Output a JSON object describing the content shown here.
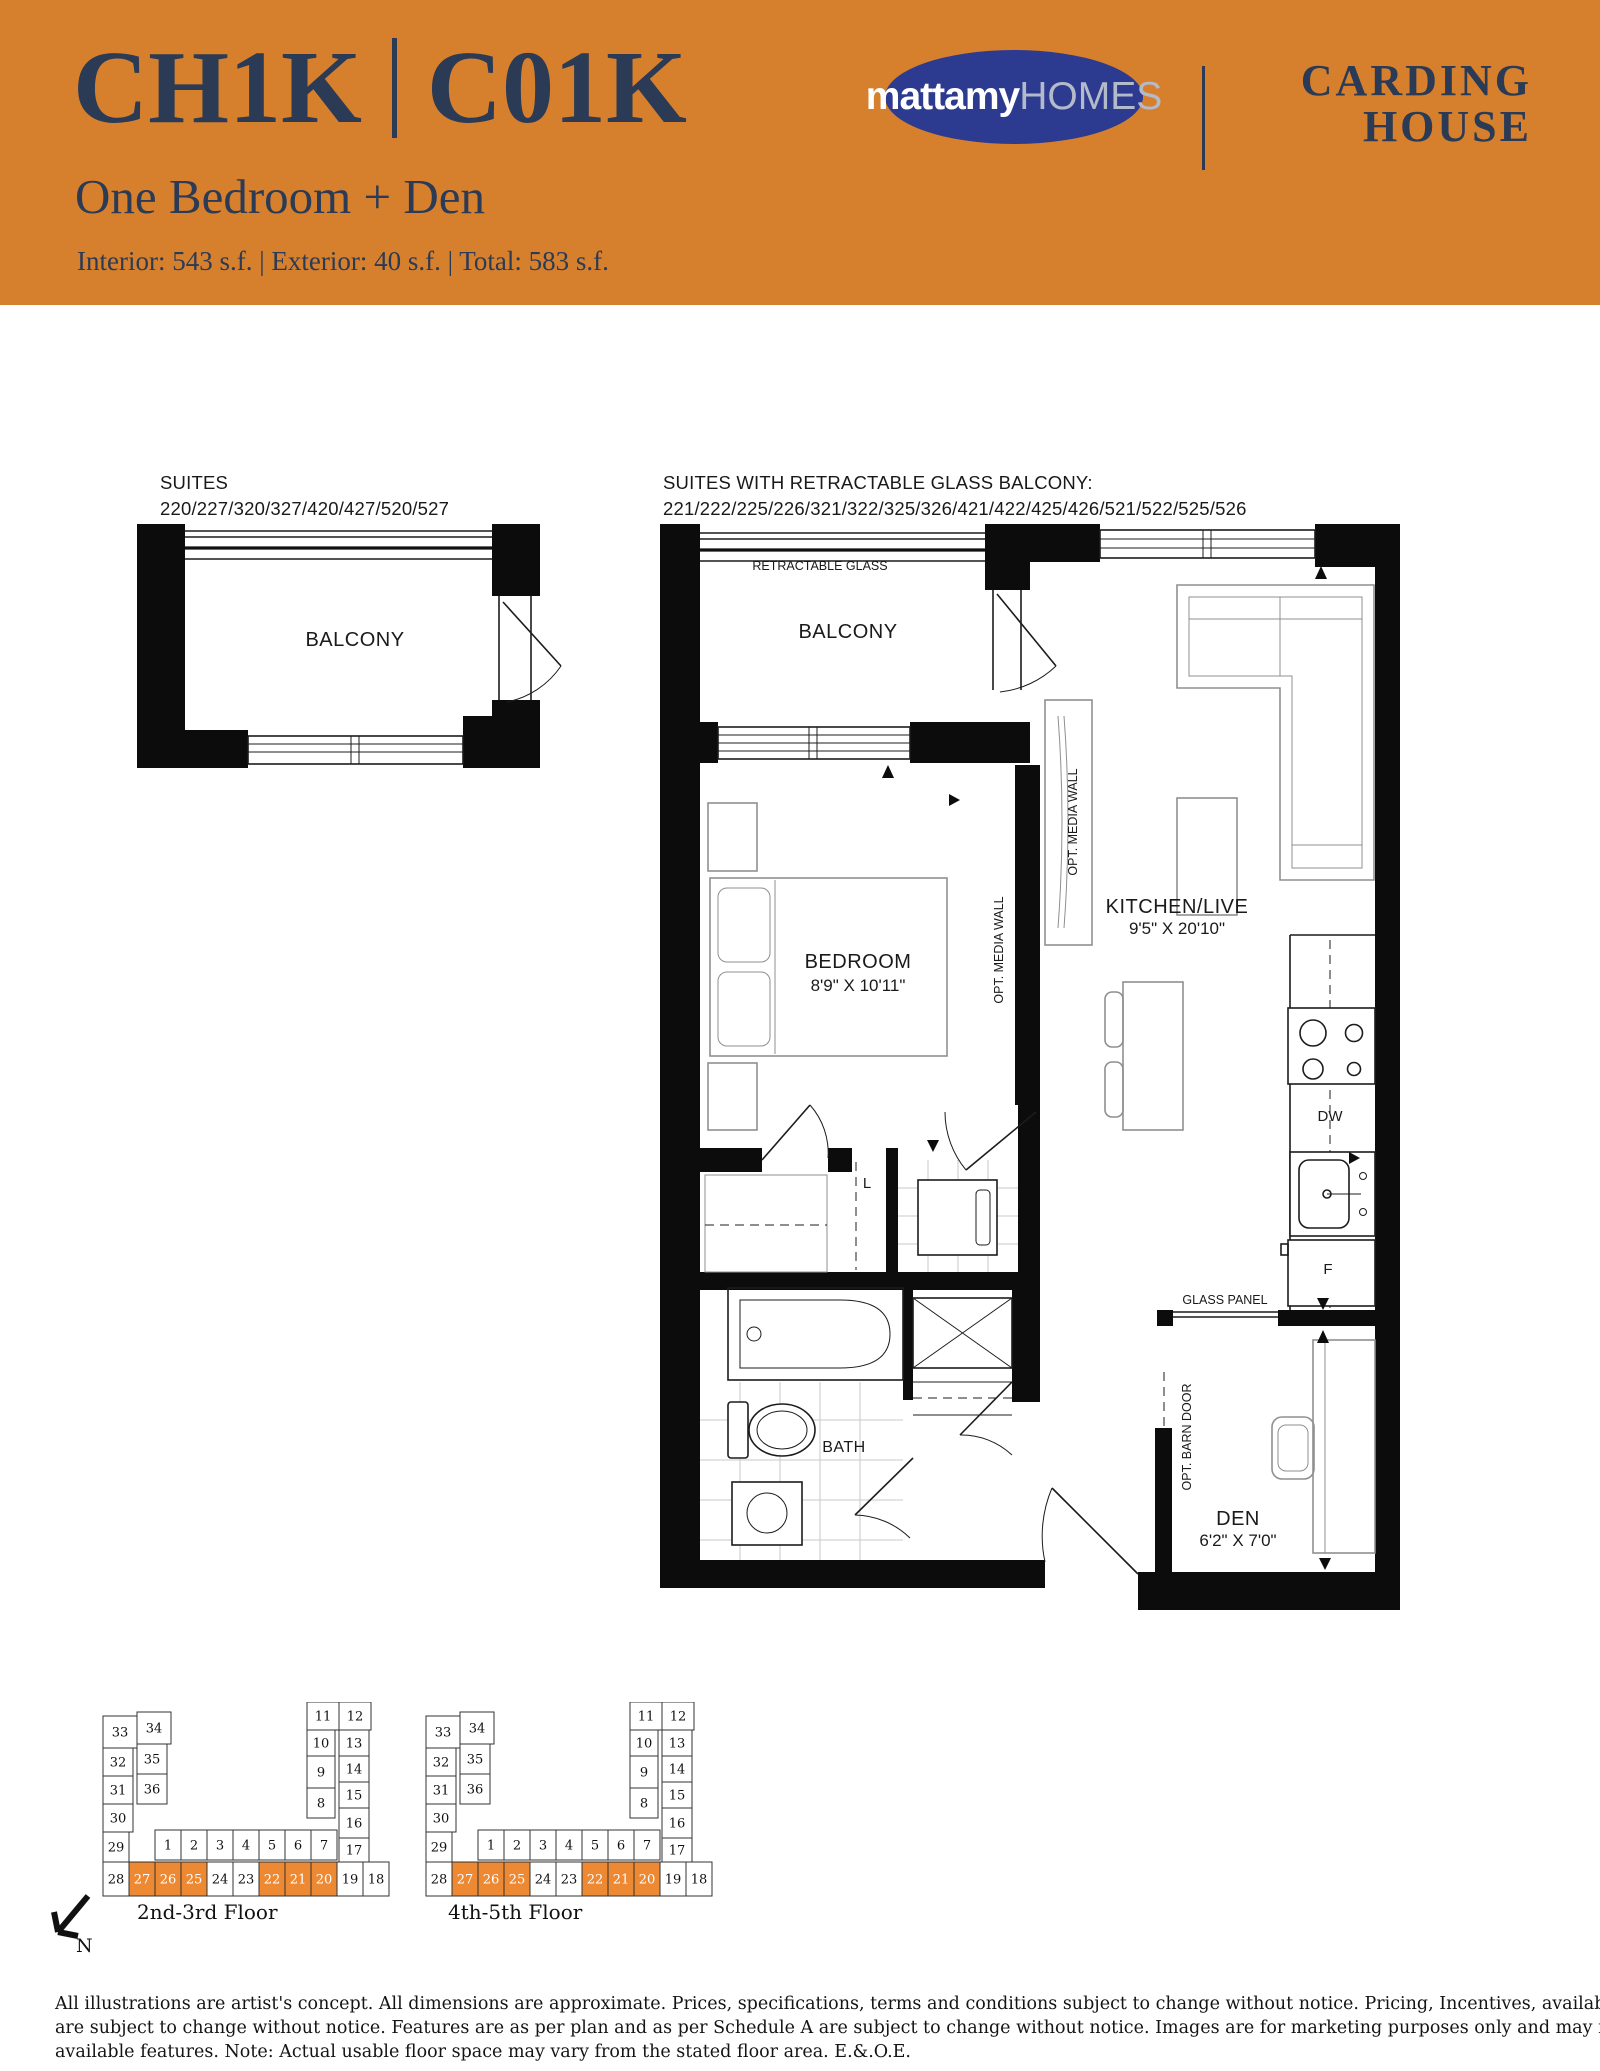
{
  "header": {
    "model_code_left": "CH1K",
    "model_code_right": "C01K",
    "unit_type": "One Bedroom + Den",
    "area_summary": "Interior: 543 s.f. | Exterior: 40 s.f. | Total: 583 s.f.",
    "logo_bold": "mattamy",
    "logo_light": "HOMES",
    "project_line1": "CARDING",
    "project_line2": "HOUSE",
    "colors": {
      "band": "#D6802E",
      "navy": "#2B3A55",
      "logo_blue": "#2C3A8F"
    }
  },
  "plans": {
    "standard": {
      "suites_title": "SUITES",
      "suites_numbers": "220/227/320/327/420/427/520/527",
      "balcony": "BALCONY"
    },
    "retractable": {
      "suites_title": "SUITES WITH RETRACTABLE GLASS BALCONY:",
      "suites_numbers": "221/222/225/226/321/322/325/326/421/422/425/426/521/522/525/526",
      "retractable_glass": "RETRACTABLE GLASS",
      "balcony": "BALCONY",
      "bedroom_name": "BEDROOM",
      "bedroom_dims": "8'9\" X 10'11\"",
      "kitchen_name": "KITCHEN/LIVE",
      "kitchen_dims": "9'5\" X 20'10\"",
      "den_name": "DEN",
      "den_dims": "6'2\" X 7'0\"",
      "bath": "BATH",
      "laundry": "L",
      "dishwasher": "DW",
      "fridge": "F",
      "glass_panel": "GLASS PANEL",
      "opt_media_wall": "OPT. MEDIA WALL",
      "opt_barn_door": "OPT. BARN DOOR"
    }
  },
  "keyplans": {
    "floors": [
      "2nd-3rd Floor",
      "4th-5th Floor"
    ],
    "north_label": "N",
    "highlight_color": "#ED8833",
    "highlighted_units": [
      "27",
      "26",
      "25",
      "22",
      "21",
      "20"
    ],
    "cells": [
      {
        "n": "33",
        "x": 8,
        "y": 14,
        "w": 34,
        "h": 32
      },
      {
        "n": "34",
        "x": 42,
        "y": 10,
        "w": 34,
        "h": 32
      },
      {
        "n": "32",
        "x": 8,
        "y": 46,
        "w": 30,
        "h": 28
      },
      {
        "n": "35",
        "x": 42,
        "y": 42,
        "w": 30,
        "h": 30
      },
      {
        "n": "31",
        "x": 8,
        "y": 74,
        "w": 30,
        "h": 28
      },
      {
        "n": "36",
        "x": 42,
        "y": 72,
        "w": 30,
        "h": 30
      },
      {
        "n": "30",
        "x": 8,
        "y": 102,
        "w": 30,
        "h": 28
      },
      {
        "n": "29",
        "x": 8,
        "y": 130,
        "w": 26,
        "h": 30
      },
      {
        "n": "1",
        "x": 60,
        "y": 128,
        "w": 26,
        "h": 30
      },
      {
        "n": "2",
        "x": 86,
        "y": 128,
        "w": 26,
        "h": 30
      },
      {
        "n": "3",
        "x": 112,
        "y": 128,
        "w": 26,
        "h": 30
      },
      {
        "n": "4",
        "x": 138,
        "y": 128,
        "w": 26,
        "h": 30
      },
      {
        "n": "5",
        "x": 164,
        "y": 128,
        "w": 26,
        "h": 30
      },
      {
        "n": "6",
        "x": 190,
        "y": 128,
        "w": 26,
        "h": 30
      },
      {
        "n": "7",
        "x": 216,
        "y": 128,
        "w": 26,
        "h": 30
      },
      {
        "n": "28",
        "x": 8,
        "y": 160,
        "w": 26,
        "h": 34
      },
      {
        "n": "27",
        "x": 34,
        "y": 160,
        "w": 26,
        "h": 34
      },
      {
        "n": "26",
        "x": 60,
        "y": 160,
        "w": 26,
        "h": 34
      },
      {
        "n": "25",
        "x": 86,
        "y": 160,
        "w": 26,
        "h": 34
      },
      {
        "n": "24",
        "x": 112,
        "y": 160,
        "w": 26,
        "h": 34
      },
      {
        "n": "23",
        "x": 138,
        "y": 160,
        "w": 26,
        "h": 34
      },
      {
        "n": "22",
        "x": 164,
        "y": 160,
        "w": 26,
        "h": 34
      },
      {
        "n": "21",
        "x": 190,
        "y": 160,
        "w": 26,
        "h": 34
      },
      {
        "n": "20",
        "x": 216,
        "y": 160,
        "w": 26,
        "h": 34
      },
      {
        "n": "19",
        "x": 242,
        "y": 160,
        "w": 26,
        "h": 34
      },
      {
        "n": "18",
        "x": 268,
        "y": 160,
        "w": 26,
        "h": 34
      },
      {
        "n": "11",
        "x": 212,
        "y": 0,
        "w": 32,
        "h": 28
      },
      {
        "n": "12",
        "x": 244,
        "y": 0,
        "w": 32,
        "h": 28
      },
      {
        "n": "10",
        "x": 212,
        "y": 28,
        "w": 28,
        "h": 26
      },
      {
        "n": "13",
        "x": 244,
        "y": 28,
        "w": 30,
        "h": 26
      },
      {
        "n": "9",
        "x": 212,
        "y": 54,
        "w": 28,
        "h": 32
      },
      {
        "n": "14",
        "x": 244,
        "y": 54,
        "w": 30,
        "h": 26
      },
      {
        "n": "15",
        "x": 244,
        "y": 80,
        "w": 30,
        "h": 26
      },
      {
        "n": "8",
        "x": 212,
        "y": 86,
        "w": 28,
        "h": 30
      },
      {
        "n": "16",
        "x": 244,
        "y": 106,
        "w": 30,
        "h": 30
      },
      {
        "n": "17",
        "x": 244,
        "y": 136,
        "w": 30,
        "h": 24
      }
    ]
  },
  "disclaimer": {
    "lines": [
      "All illustrations are artist's concept. All dimensions are approximate. Prices, specifications, terms and conditions subject to change without notice. Pricing, Incentives, availability, and plans",
      "are subject to change without notice. Features are as per plan and as per Schedule A are subject to change without notice. Images are for marketing purposes only and may not reflect included/",
      "available features. Note: Actual usable floor space may vary from the stated floor area. E.&.O.E."
    ]
  }
}
